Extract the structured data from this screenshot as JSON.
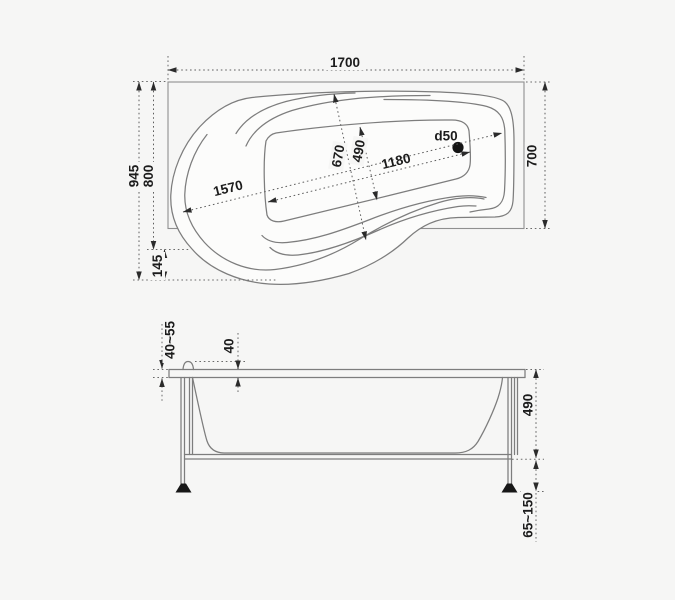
{
  "drawing_name": "asymmetric bathtub technical drawing",
  "colors": {
    "background": "#f6f6f5",
    "outline": "#7d7d7d",
    "dimension_line": "#5f5f5f",
    "text": "#1c1c1c",
    "accent_fill": "#171717"
  },
  "top_view": {
    "dims": {
      "overall_length": "1700",
      "right_width": "700",
      "left_width": "945",
      "left_width_inner": "800",
      "bottom_offset": "145",
      "inner_length": "1570",
      "basin_length": "1180",
      "mid_width": "670",
      "basin_width": "490",
      "drain": "d50"
    }
  },
  "front_view": {
    "dims": {
      "rim_thickness": "40~55",
      "rim_step": "40",
      "height": "490",
      "feet_range": "65~150"
    }
  }
}
